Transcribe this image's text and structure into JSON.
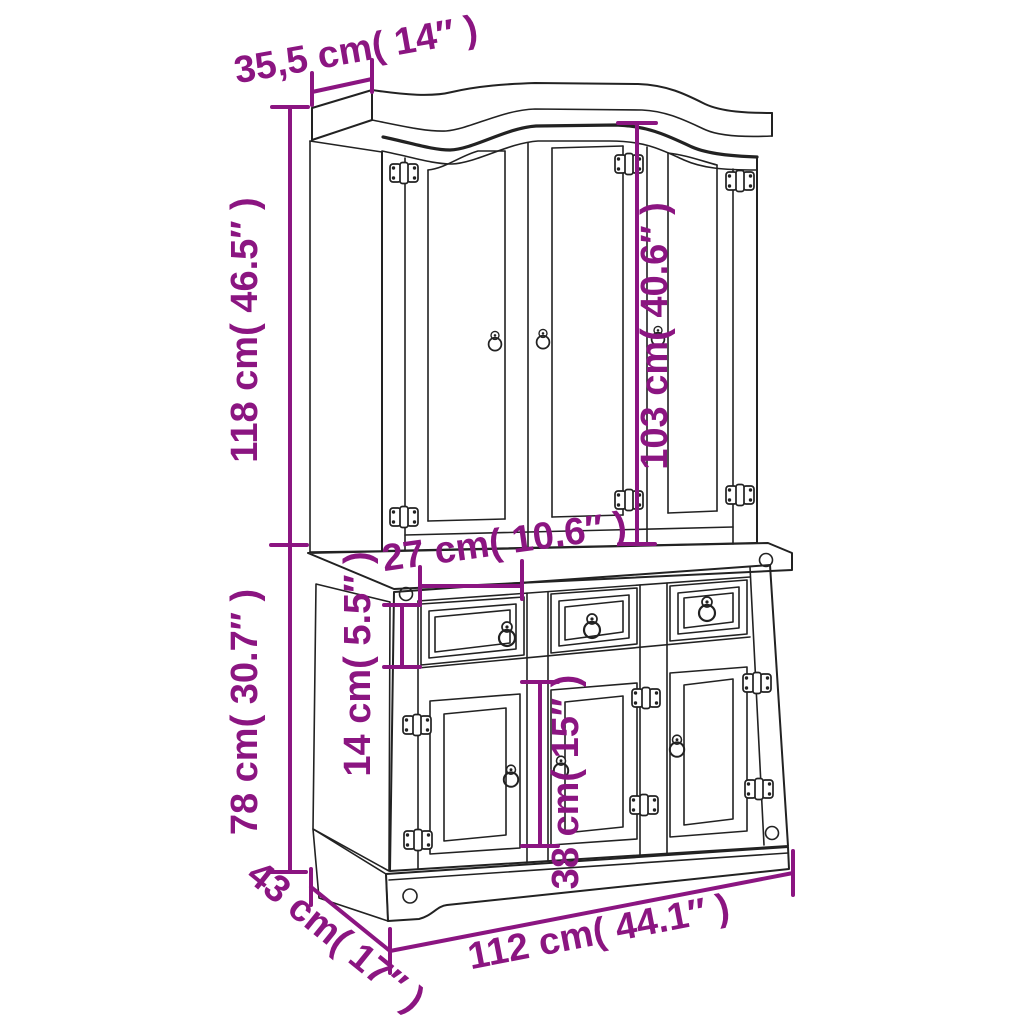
{
  "diagram": {
    "subject": "three-door-hutch-dresser-with-three-drawers-and-three-lower-doors",
    "accent_color": "#8B1581",
    "line_color": "#222222",
    "background_color": "#FFFFFF",
    "dimensions": [
      {
        "name": "top-depth",
        "label": "35,5 cm( 14″ )",
        "cm": "35,5",
        "inches": "14"
      },
      {
        "name": "hutch-height",
        "label": "118 cm( 46.5″ )",
        "cm": "118",
        "inches": "46.5"
      },
      {
        "name": "hutch-door-height",
        "label": "103 cm( 40.6″ )",
        "cm": "103",
        "inches": "40.6"
      },
      {
        "name": "drawer-width",
        "label": "27 cm( 10.6″ )",
        "cm": "27",
        "inches": "10.6"
      },
      {
        "name": "drawer-height",
        "label": "14 cm( 5.5″ )",
        "cm": "14",
        "inches": "5.5"
      },
      {
        "name": "base-height",
        "label": "78 cm( 30.7″ )",
        "cm": "78",
        "inches": "30.7"
      },
      {
        "name": "lower-door-height",
        "label": "38 cm( 15″ )",
        "cm": "38",
        "inches": "15"
      },
      {
        "name": "base-depth",
        "label": "43 cm( 17″ )",
        "cm": "43",
        "inches": "17"
      },
      {
        "name": "overall-width",
        "label": "112 cm( 44.1″ )",
        "cm": "112",
        "inches": "44.1"
      }
    ]
  }
}
